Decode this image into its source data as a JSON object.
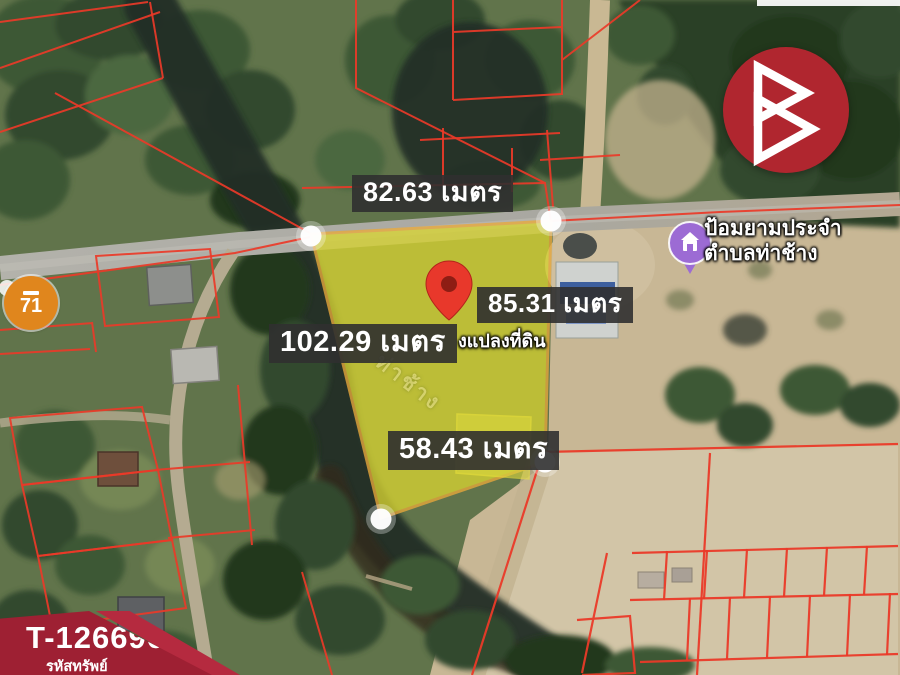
{
  "map": {
    "measurements": {
      "top": "82.63 เมตร",
      "right": "85.31 เมตร",
      "left": "102.29 เมตร",
      "bottom": "58.43 เมตร"
    },
    "poi": {
      "icon": "purple-place-pin",
      "line1": "ป้อมยามประจำ",
      "line2": "ตำบลท่าช้าง"
    },
    "plot": {
      "marker_icon": "red-map-pin",
      "caption_partial": "งแปลงที่ดิน",
      "fill_color": "#d6d232",
      "border_color": "#e8a83c",
      "vertex_marker": "white-dot"
    },
    "water_label": "ท่าช้าง",
    "route_shield": {
      "number": "71",
      "color": "#e0861d"
    },
    "colors": {
      "label_background": "#303030",
      "cadastral_line": "#ea3a28",
      "road": "#b0afa8",
      "river": "#202e28",
      "field": "#d2c5a7"
    }
  },
  "branding": {
    "logo_icon": "double-triangle-b-logo",
    "logo_color": "#b0262f"
  },
  "property_badge": {
    "code": "T-126696",
    "caption": "รหัสทรัพย์",
    "color": "#9e2033"
  }
}
